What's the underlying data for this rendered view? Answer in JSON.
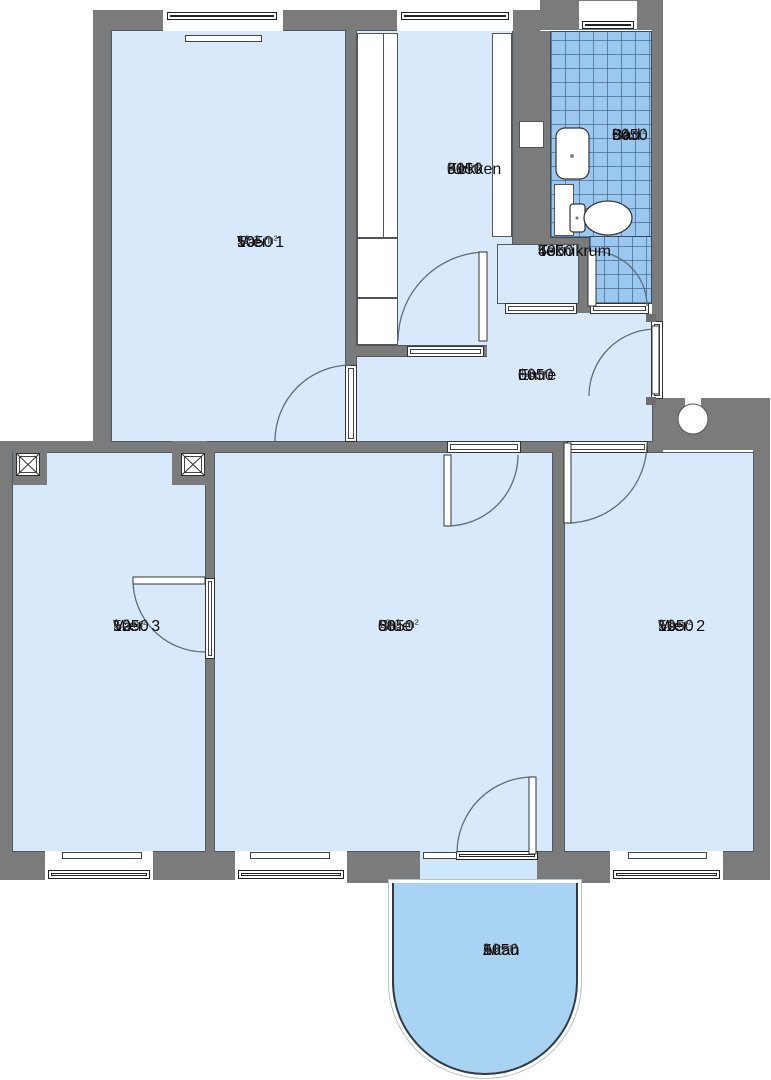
{
  "plan_title": "Apartment floor plan unit 5050",
  "unit_id": "5050",
  "rooms": {
    "vaer1": {
      "unit": "5050",
      "no": "10",
      "name": "Vær. 1",
      "area": "12.2 m²"
    },
    "koekken": {
      "unit": "5050",
      "no": "01",
      "name": "Køkken",
      "area": "6.6 m²"
    },
    "bad": {
      "unit": "5050",
      "no": "04",
      "name": "Bad",
      "area": "3.2 m²"
    },
    "teknikrum": {
      "unit": "5050",
      "no": "43",
      "name": "Teknikrum",
      "area": "0.6 m²"
    },
    "entre": {
      "unit": "5050",
      "no": "06",
      "name": "Entre",
      "area": "4.2 m²"
    },
    "vaer3": {
      "unit": "5050",
      "no": "12",
      "name": "Vær. 3",
      "area": "9.5 m²"
    },
    "stue": {
      "unit": "5050",
      "no": "08",
      "name": "Stue",
      "area": "18.3 m²"
    },
    "vaer2": {
      "unit": "5050",
      "no": "11",
      "name": "Vær. 2",
      "area": "9.8 m²"
    },
    "altan": {
      "unit": "5050",
      "no": "16",
      "name": "Altan",
      "area": "3.9 m²"
    }
  },
  "colors": {
    "wall": "#7b7b7b",
    "room_fill": "#d9e9fc",
    "bath_tile": "#9ac8f0",
    "balcony_fill": "#a9d3f2",
    "threshold_fill": "#cfe7fb",
    "outline": "#333333",
    "text": "#0c0c0c"
  }
}
